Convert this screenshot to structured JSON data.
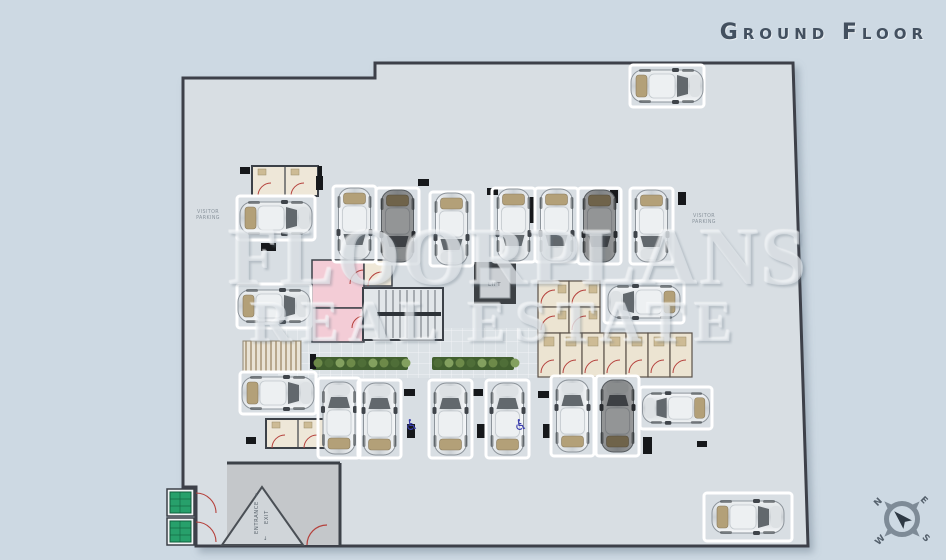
{
  "title": "Ground Floor",
  "watermark": {
    "line1": "FLOORPLANS",
    "line2": "REAL ESTATE"
  },
  "labels": {
    "visitor_left_line1": "VISITOR",
    "visitor_left_line2": "PARKING",
    "visitor_right_line1": "VISITOR",
    "visitor_right_line2": "PARKING",
    "entrance": "ENTRANCE",
    "exit": "EXIT",
    "lift": "LIFT"
  },
  "icons": {
    "wheelchair": "♿",
    "arrow_up": "↑",
    "arrow_down": "↓"
  },
  "compass": {
    "n": "N",
    "e": "E",
    "s": "S",
    "w": "W"
  },
  "colors": {
    "background": "#cdd9e3",
    "floor": "#d8dee3",
    "wall": "#3c4148",
    "door_arc": "#b5413c",
    "storage": "#ece4d2",
    "pink_room": "#f3ccd6",
    "planter_green": "#42602f",
    "meter_box_green": "#27a06b",
    "title_text": "#43505f"
  },
  "plan": {
    "parking_spots": [
      {
        "x": 333,
        "y": 186,
        "w": 43,
        "h": 76,
        "dir": "down",
        "car": true,
        "shade": "light"
      },
      {
        "x": 376,
        "y": 188,
        "w": 43,
        "h": 76,
        "dir": "down",
        "car": true,
        "shade": "dark"
      },
      {
        "x": 430,
        "y": 192,
        "w": 43,
        "h": 74,
        "dir": "down",
        "car": true,
        "shade": "light"
      },
      {
        "x": 492,
        "y": 188,
        "w": 43,
        "h": 74,
        "dir": "down",
        "car": true,
        "shade": "light"
      },
      {
        "x": 535,
        "y": 188,
        "w": 43,
        "h": 74,
        "dir": "down",
        "car": true,
        "shade": "light"
      },
      {
        "x": 578,
        "y": 188,
        "w": 43,
        "h": 76,
        "dir": "down",
        "car": true,
        "shade": "dark"
      },
      {
        "x": 630,
        "y": 188,
        "w": 43,
        "h": 76,
        "dir": "down",
        "car": true,
        "shade": "light"
      },
      {
        "x": 237,
        "y": 196,
        "w": 78,
        "h": 44,
        "dir": "right",
        "car": true,
        "shade": "light"
      },
      {
        "x": 237,
        "y": 284,
        "w": 74,
        "h": 44,
        "dir": "right",
        "car": true,
        "shade": "light"
      },
      {
        "x": 240,
        "y": 372,
        "w": 76,
        "h": 42,
        "dir": "right",
        "car": true,
        "shade": "light"
      },
      {
        "x": 318,
        "y": 378,
        "w": 42,
        "h": 80,
        "dir": "up",
        "car": true,
        "shade": "light"
      },
      {
        "x": 358,
        "y": 380,
        "w": 43,
        "h": 78,
        "dir": "up",
        "car": true,
        "shade": "light"
      },
      {
        "x": 429,
        "y": 380,
        "w": 43,
        "h": 78,
        "dir": "up",
        "car": true,
        "shade": "light"
      },
      {
        "x": 486,
        "y": 380,
        "w": 43,
        "h": 78,
        "dir": "up",
        "car": true,
        "shade": "light"
      },
      {
        "x": 551,
        "y": 376,
        "w": 43,
        "h": 80,
        "dir": "up",
        "car": true,
        "shade": "light"
      },
      {
        "x": 596,
        "y": 376,
        "w": 43,
        "h": 80,
        "dir": "up",
        "car": true,
        "shade": "dark"
      },
      {
        "x": 604,
        "y": 281,
        "w": 80,
        "h": 42,
        "dir": "left",
        "car": true,
        "shade": "light"
      },
      {
        "x": 640,
        "y": 387,
        "w": 72,
        "h": 42,
        "dir": "left",
        "car": true,
        "shade": "light",
        "s": 0.93
      },
      {
        "x": 630,
        "y": 65,
        "w": 74,
        "h": 42,
        "dir": "right",
        "car": true,
        "shade": "light"
      },
      {
        "x": 704,
        "y": 493,
        "w": 88,
        "h": 48,
        "dir": "right",
        "car": true,
        "shade": "light"
      }
    ]
  }
}
